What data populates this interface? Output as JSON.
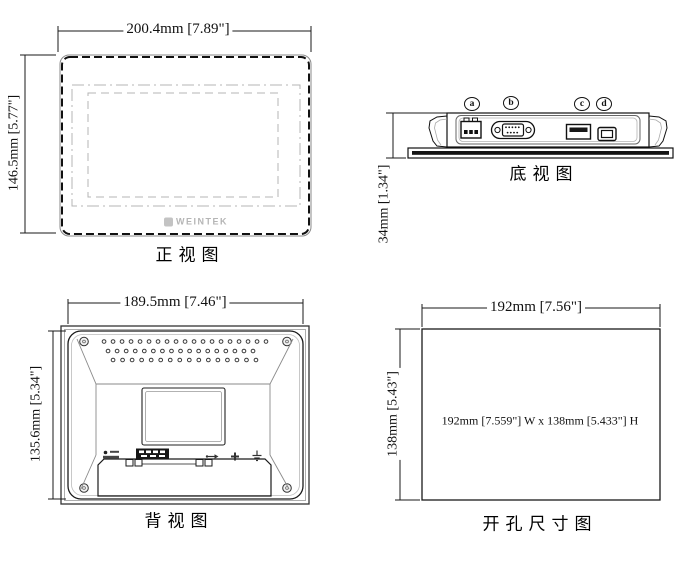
{
  "views": {
    "front": {
      "label": "正视图",
      "width_dim": "200.4mm [7.89\"]",
      "height_dim": "146.5mm [5.77\"]",
      "brand": "WEINTEK"
    },
    "bottom": {
      "label": "底视图",
      "height_dim": "34mm [1.34\"]",
      "port_labels": [
        "a",
        "b",
        "c",
        "d"
      ]
    },
    "back": {
      "label": "背视图",
      "width_dim": "189.5mm [7.46\"]",
      "height_dim": "135.6mm [5.34\"]"
    },
    "cutout": {
      "label": "开孔尺寸图",
      "width_dim": "192mm [7.56\"]",
      "height_dim": "138mm [5.43\"]",
      "note": "192mm [7.559\"] W x 138mm [5.433\"] H"
    }
  },
  "colors": {
    "line": "#1a1a1a",
    "construction_gray": "#b4b4b4",
    "logo_gray": "#b5b5b5"
  }
}
